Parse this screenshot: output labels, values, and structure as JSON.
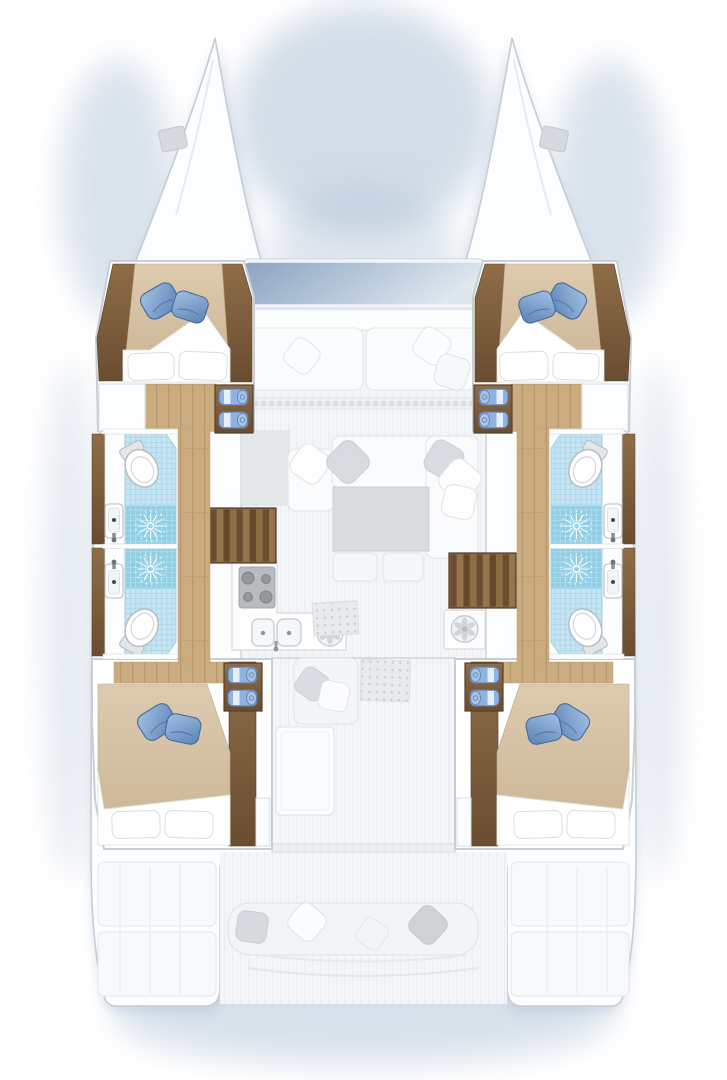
{
  "title": "Catamaran interior layout floor plan, top-down view",
  "view": "top-down deck and interior plan",
  "vessel": {
    "type": "sailing catamaran",
    "hulls": 2,
    "cabins": 4,
    "heads": 4,
    "stairways": 2
  },
  "areas": {
    "bows": [
      "port bow",
      "starboard bow"
    ],
    "forward_cabins": [
      {
        "position": "port forward",
        "bed": "double berth",
        "blue_pillows": 2,
        "white_pillows": 2,
        "towel_shelf_towels": 2
      },
      {
        "position": "starboard forward",
        "bed": "double berth",
        "blue_pillows": 2,
        "white_pillows": 2,
        "towel_shelf_towels": 2
      }
    ],
    "aft_cabins": [
      {
        "position": "port aft",
        "bed": "double berth",
        "blue_pillows": 2,
        "white_pillows": 2,
        "towel_shelf_towels": 2
      },
      {
        "position": "starboard aft",
        "bed": "double berth",
        "blue_pillows": 2,
        "white_pillows": 2,
        "towel_shelf_towels": 2
      }
    ],
    "heads": [
      {
        "position": "port forward",
        "fixtures": [
          "toilet",
          "shower",
          "washbasin"
        ]
      },
      {
        "position": "port aft",
        "fixtures": [
          "toilet",
          "shower",
          "washbasin"
        ]
      },
      {
        "position": "starboard forward",
        "fixtures": [
          "toilet",
          "shower",
          "washbasin"
        ]
      },
      {
        "position": "starboard aft",
        "fixtures": [
          "toilet",
          "shower",
          "washbasin"
        ]
      }
    ],
    "salon": {
      "forward_bench_cushions": 2,
      "sofa_pillows": 5,
      "table": 1,
      "ottomans": 2,
      "window_band": "forward tinted windows"
    },
    "galley": {
      "stove_burners": 4,
      "sink_bowls": 2,
      "round_appliance": 1
    },
    "utility": {
      "round_appliance": 1
    },
    "cockpit": {
      "bench_pillows": 4,
      "swim_platforms": 2
    },
    "aft_salon": {
      "bench": 1,
      "table": 1,
      "door_mats": 2
    }
  },
  "colors": {
    "hull-fill": "#fcfdfe",
    "hull-stroke": "#c6ccd3",
    "shadow": "#a9bdd3",
    "deck": "#f3f5f7",
    "deck-line": "#eaedf0",
    "wall-stroke": "#c9ced4",
    "furn": "#fafbfc",
    "furn-stroke": "#e2e5e9",
    "pillow-gray": "#d8dbdf",
    "table": "#d9dbde",
    "win1": "#8aa2bf",
    "win2": "#b7c8da",
    "win3": "#dfe7ef",
    "wood1": "#8e6d47",
    "wood2": "#6a4c30",
    "wood-stroke": "#55402a",
    "floor1": "#cbac81",
    "floor-line": "#b8976c",
    "duvet1": "#ddcbb0",
    "duvet2": "#c9b391",
    "duvet-stroke": "#bfa98a",
    "linen": "#ffffff",
    "linen-stroke": "#dcdedd",
    "bluepil1": "#a3c0e4",
    "bluepil2": "#5a82b4",
    "bluepil-stroke": "#3f6697",
    "tile": "#c6e4f1",
    "tile-line": "#aad6e8",
    "tile-stroke": "#9fcfe3",
    "shower": "#8fcee4",
    "towel": "#8fb3de",
    "towel-stroke": "#5c7fae",
    "towel-stripe": "#eef4fb",
    "towel-roll": "#a9c4e6",
    "fixture-stroke": "#b4bac1",
    "appliance": "#b9bcbf",
    "burner": "#95989b",
    "mat": "#e8eaed",
    "mat-dot": "#c5c9ce"
  }
}
